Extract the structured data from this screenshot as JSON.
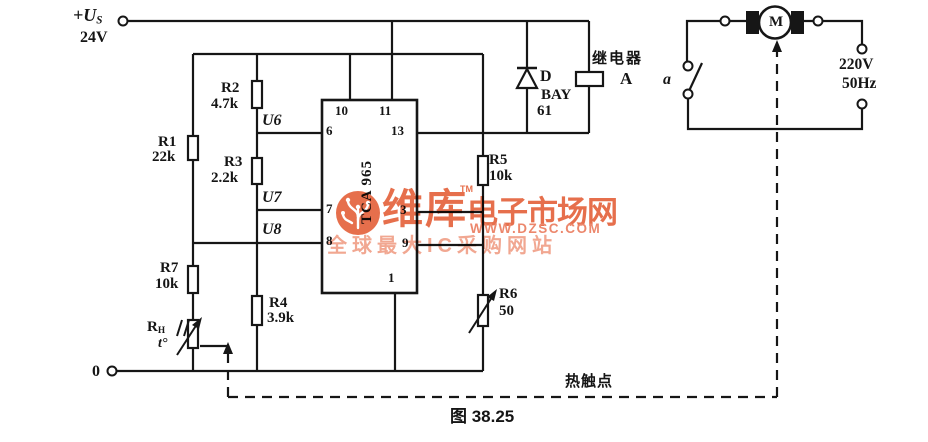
{
  "power": {
    "vs_label": "+U",
    "vs_sub": "S",
    "vs_value": "24V",
    "gnd_label": "0"
  },
  "resistors": {
    "r1": {
      "name": "R1",
      "value": "22k"
    },
    "r2": {
      "name": "R2",
      "value": "4.7k"
    },
    "r3": {
      "name": "R3",
      "value": "2.2k"
    },
    "r4": {
      "name": "R4",
      "value": "3.9k"
    },
    "r5": {
      "name": "R5",
      "value": "10k"
    },
    "r6": {
      "name": "R6",
      "value": "50"
    },
    "r7": {
      "name": "R7",
      "value": "10k"
    },
    "rh": {
      "name": "R",
      "sub": "H",
      "temp": "t°"
    }
  },
  "ic": {
    "label": "TCA 965",
    "nodes": {
      "u6": "U6",
      "u7": "U7",
      "u8": "U8"
    },
    "pins": {
      "p10": "10",
      "p11": "11",
      "p6": "6",
      "p7": "7",
      "p8": "8",
      "p13": "13",
      "p3": "3",
      "p9": "9",
      "p1": "1"
    }
  },
  "diode": {
    "ref": "D",
    "part_line1": "BAY",
    "part_line2": "61"
  },
  "relay": {
    "label": "继电器",
    "ref": "A"
  },
  "switch": {
    "label": "a"
  },
  "motor": {
    "label": "M"
  },
  "ac_supply": {
    "voltage": "220V",
    "frequency": "50Hz"
  },
  "thermal": {
    "contact_label": "热触点"
  },
  "caption": "图 38.25",
  "watermark": {
    "brand": "维库",
    "tm": "TM",
    "suffix": "电子市场网",
    "url": "WWW.DZSC.COM",
    "tagline": "全球最大IC采购网站",
    "color": "#e45f38",
    "url_color": "#ea7a5c",
    "tagline_color": "#f09d85"
  },
  "colors": {
    "ink": "#161616",
    "background": "#ffffff"
  }
}
